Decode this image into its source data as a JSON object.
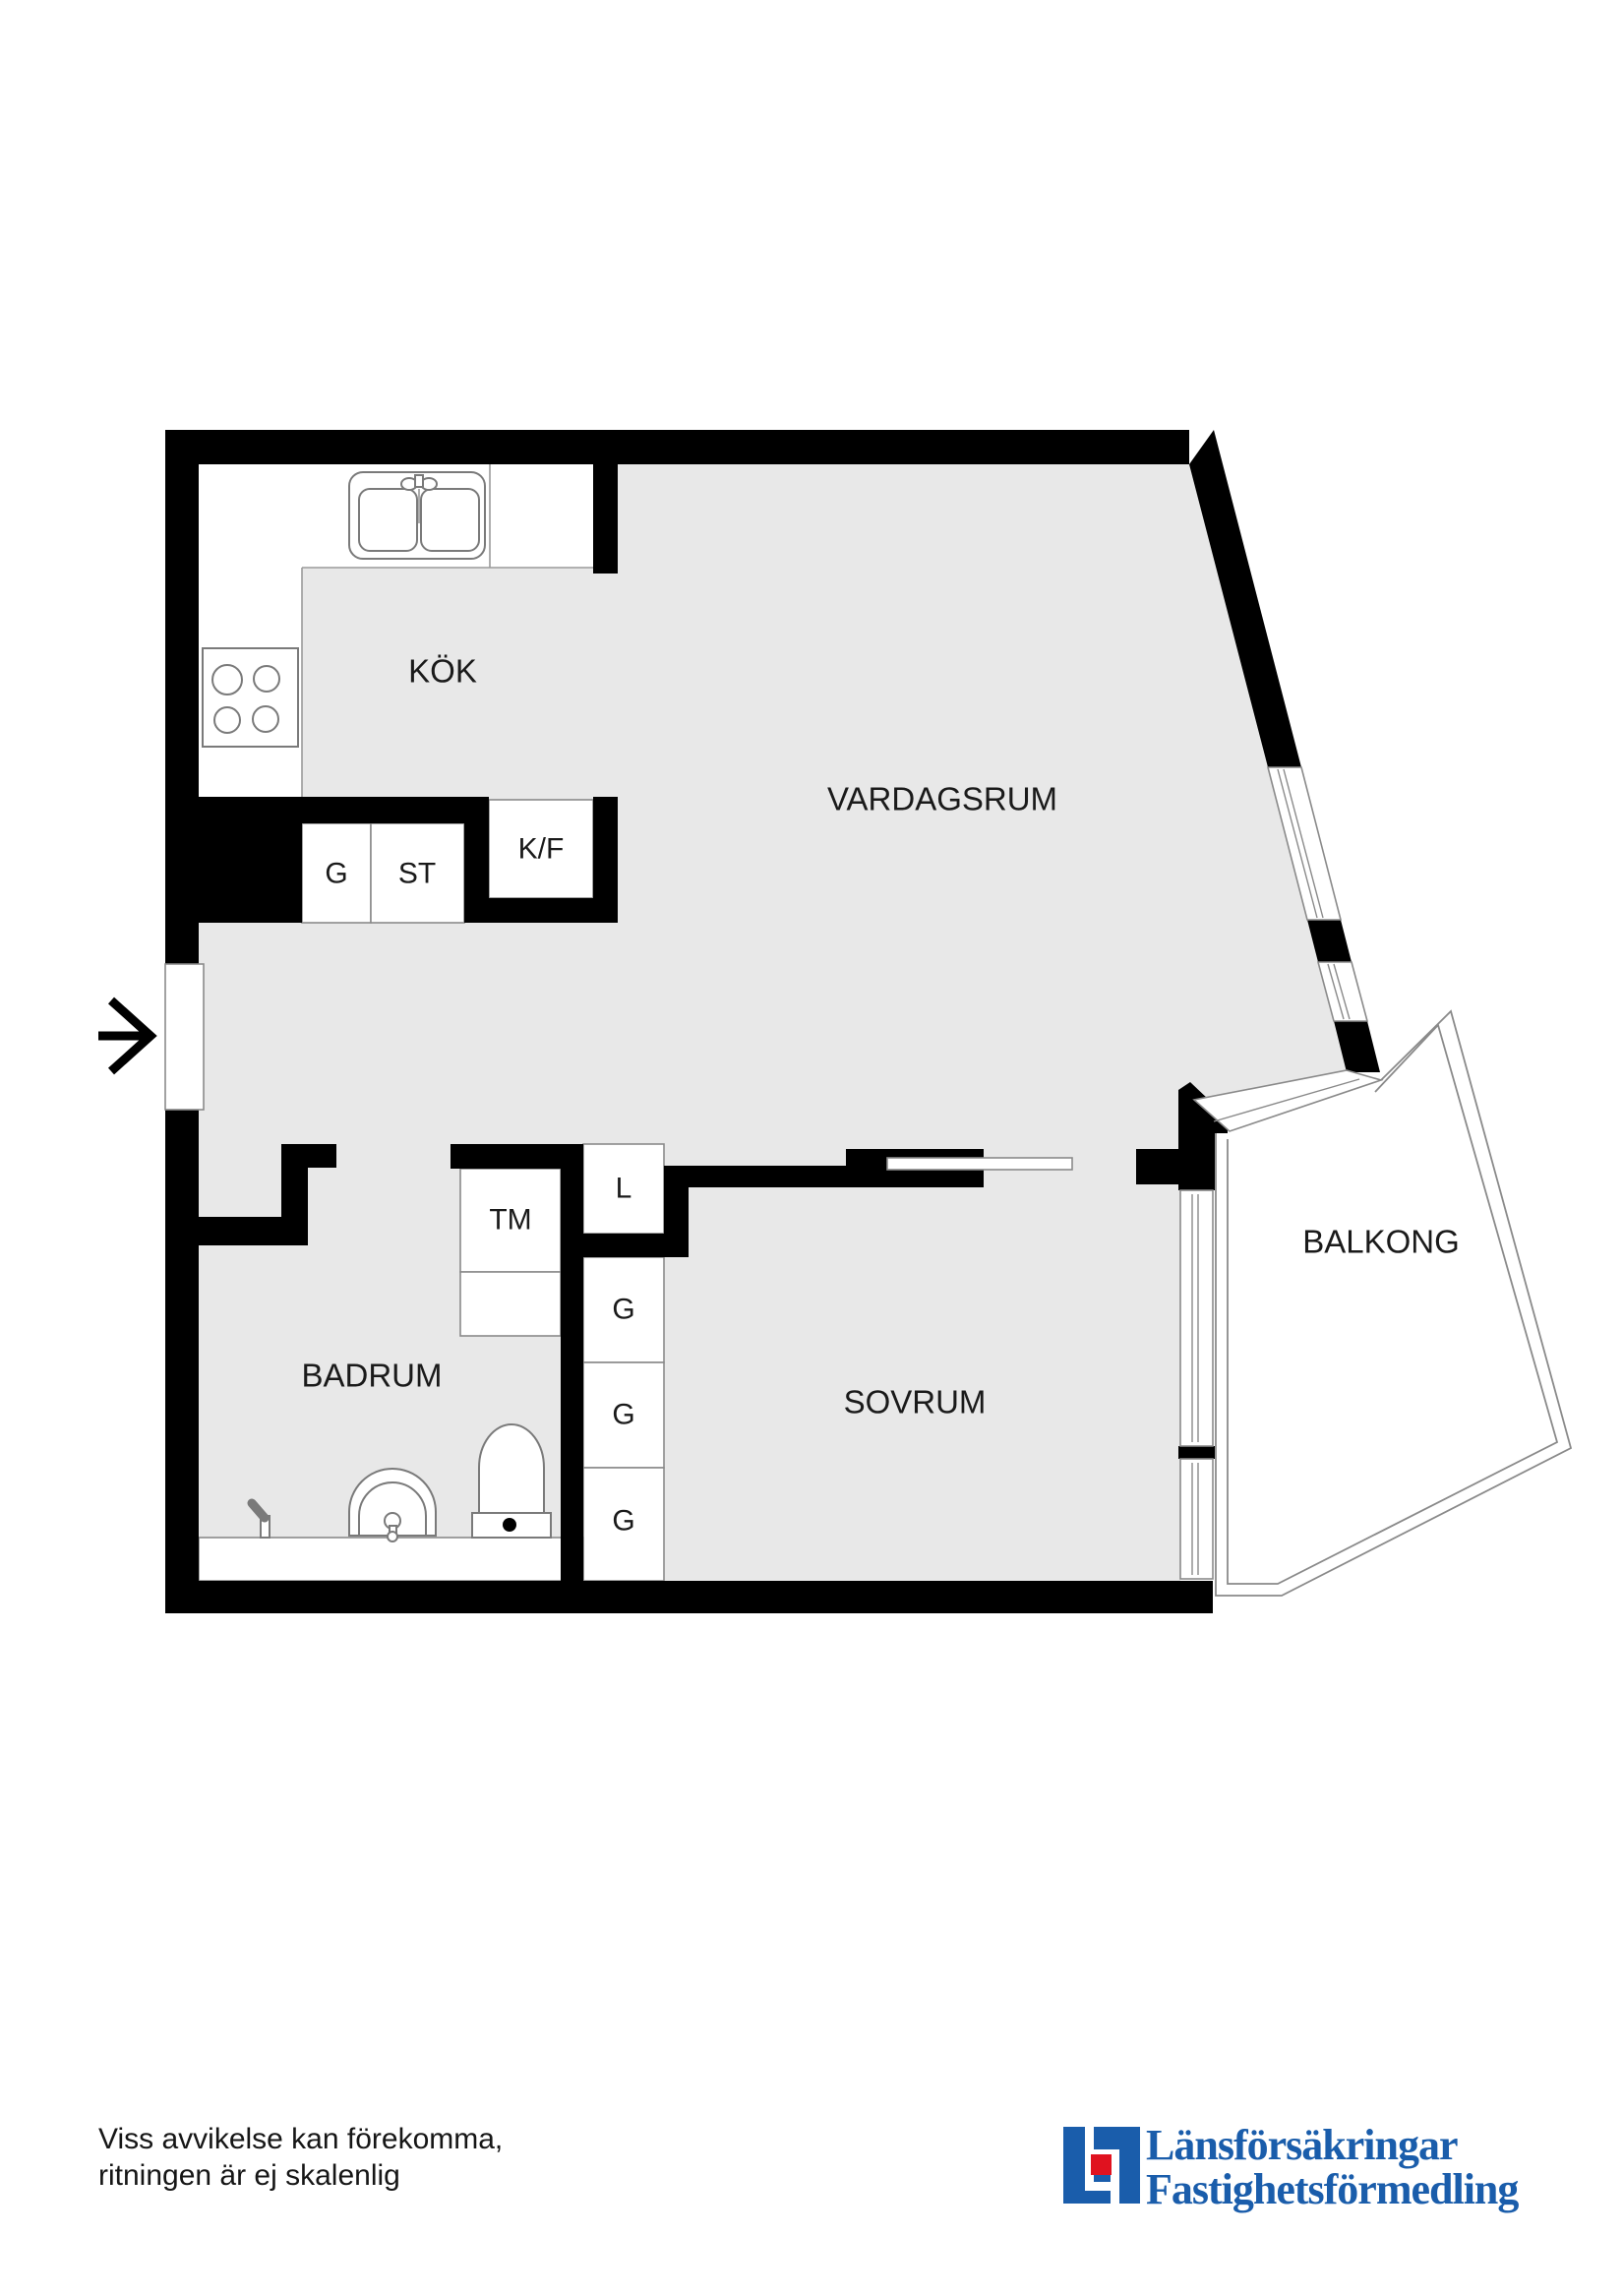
{
  "floorplan": {
    "rooms": {
      "kitchen": "KÖK",
      "living_room": "VARDAGSRUM",
      "bathroom": "BADRUM",
      "bedroom": "SOVRUM",
      "balcony": "BALKONG"
    },
    "closets": {
      "wardrobe_hall": "G",
      "cleaning": "ST",
      "fridge_freezer": "K/F",
      "washing_machine": "TM",
      "linen": "L",
      "bedroom_wardrobe_1": "G",
      "bedroom_wardrobe_2": "G",
      "bedroom_wardrobe_3": "G"
    },
    "icons": {
      "entry_arrow": "entry-arrow-icon",
      "stove": "stove-icon",
      "kitchen_sink": "kitchen-sink-icon",
      "bathroom_sink": "washbasin-icon",
      "toilet": "toilet-icon",
      "tap": "tap-icon"
    },
    "colors": {
      "floor": "#e8e8e8",
      "wall": "#000000",
      "line": "#8a8a8a"
    }
  },
  "footer": {
    "disclaimer": {
      "line1": "Viss avvikelse kan förekomma,",
      "line2": "ritningen är ej skalenlig"
    },
    "logo": {
      "name_line1": "Länsförsäkringar",
      "name_line2": "Fastighetsförmedling",
      "blue": "#1a5dab",
      "red": "#e0121f"
    }
  }
}
